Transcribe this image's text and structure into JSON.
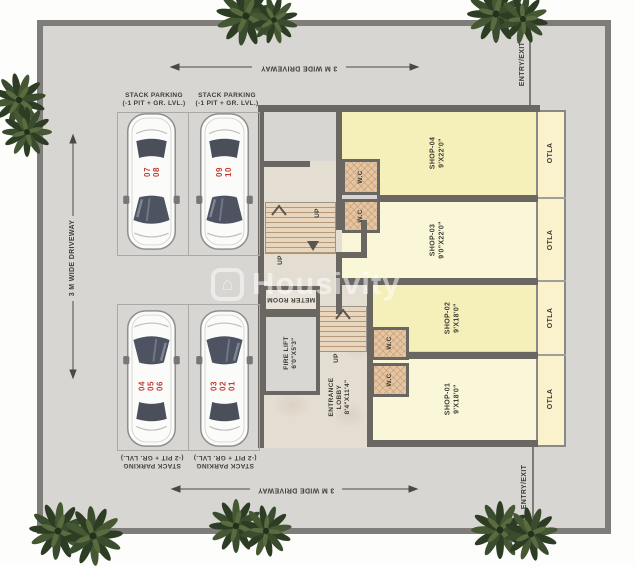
{
  "site": {
    "driveway_label_top": "3 M WIDE DRIVEWAY",
    "driveway_label_left": "3 M WIDE DRIVEWAY",
    "driveway_label_bottom": "3 M WIDE DRIVEWAY",
    "entry_exit_top": "ENTRY/EXIT",
    "entry_exit_bottom": "ENTRY/EXIT"
  },
  "parking": {
    "bays_top": [
      {
        "line1": "STACK PARKING",
        "line2": "(-1 PIT + GR. LVL.)"
      },
      {
        "line1": "STACK PARKING",
        "line2": "(-1 PIT + GR. LVL.)"
      }
    ],
    "bays_bottom": [
      {
        "line1": "STACK PARKING",
        "line2": "(-2 PIT + GR. LVL.)"
      },
      {
        "line1": "STACK PARKING",
        "line2": "(-2 PIT + GR. LVL.)"
      }
    ],
    "cars": [
      {
        "numbers": [
          "07",
          "08"
        ]
      },
      {
        "numbers": [
          "09",
          "10"
        ]
      },
      {
        "numbers": [
          "04",
          "05",
          "06"
        ]
      },
      {
        "numbers": [
          "03",
          "02",
          "01"
        ]
      }
    ]
  },
  "shops": [
    {
      "name": "SHOP-04",
      "size": "9'X22'0\"",
      "otla": "OTLA",
      "wc": "W.C"
    },
    {
      "name": "SHOP-03",
      "size": "9'0\"X22'0\"",
      "otla": "OTLA",
      "wc": "W.C"
    },
    {
      "name": "SHOP-02",
      "size": "9'X18'0\"",
      "otla": "OTLA",
      "wc": "W.C"
    },
    {
      "name": "SHOP-01",
      "size": "9'X18'0\"",
      "otla": "OTLA",
      "wc": "W.C"
    }
  ],
  "core": {
    "meter_room": "METER ROOM",
    "fire_lift": {
      "line1": "FIRE LIFT",
      "line2": "6'0\"X5'3\""
    },
    "entrance_lobby": {
      "line1": "ENTRANCE",
      "line2": "LOBBY",
      "line3": "8'4\"X11'4\""
    },
    "stairs_up_label": "UP"
  },
  "watermark": {
    "brand": "Housivity",
    "icon": "house-icon",
    "icon_glyph": "⌂"
  },
  "colors": {
    "driveway": "#d7d6d3",
    "site_border": "#7f7d79",
    "wall": "#6a6762",
    "shop_yellow": "#f5efba",
    "shop_yellow_light": "#faf6d8",
    "otla_yellow": "#f9f2cc",
    "stairs_tan": "#e9d6bf",
    "wc_tan": "#e5c6a4",
    "lobby_beige": "#e4ddd2",
    "car_number_red": "#c43b33",
    "tree_green": "#3a4c2e"
  }
}
